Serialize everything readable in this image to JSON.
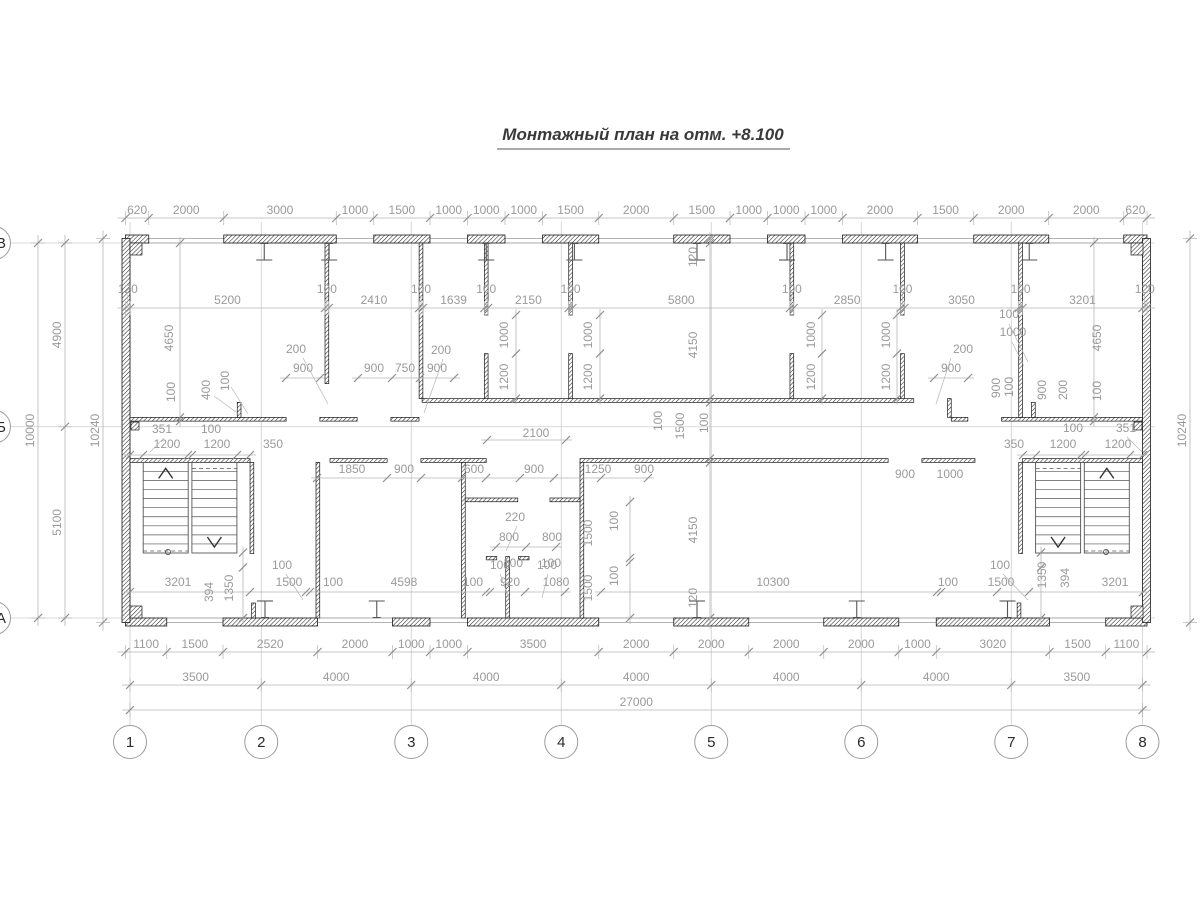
{
  "title": {
    "text": "Монтажный план на отм. +8.100"
  },
  "colors": {
    "dim_line": "#b5b5b5",
    "tick": "#8f8f8f",
    "dim_text": "#9a9a9a",
    "grid": "#cdcdcd",
    "wall_stroke": "#1a1a1a",
    "stair": "#555555",
    "face_line": "#9a9a9a",
    "bubble": "#9c9c9c",
    "title_underline": "#555555"
  },
  "scale": {
    "s": 0.0375,
    "ox": 125.5,
    "oy": 238.5
  },
  "grid": {
    "cols": [
      {
        "label": "1",
        "mm": 120
      },
      {
        "label": "2",
        "mm": 3620
      },
      {
        "label": "3",
        "mm": 7620
      },
      {
        "label": "4",
        "mm": 11620
      },
      {
        "label": "5",
        "mm": 15620
      },
      {
        "label": "6",
        "mm": 19620
      },
      {
        "label": "7",
        "mm": 23620
      },
      {
        "label": "8",
        "mm": 27120
      }
    ],
    "rows": [
      {
        "label": "В",
        "mm": 120
      },
      {
        "label": "Б",
        "mm": 5020
      },
      {
        "label": "А",
        "mm": 10120
      }
    ],
    "bubble_y": 742,
    "bubble_x": -6,
    "r": 16.5
  },
  "building": {
    "w_mm": 27240,
    "h_mm": 10240
  },
  "walls_ext": [
    {
      "ex": "t",
      "segs": [
        [
          0,
          0,
          620,
          120
        ],
        [
          2620,
          0,
          3000,
          120
        ],
        [
          6620,
          0,
          1500,
          120
        ],
        [
          9120,
          0,
          1000,
          120
        ],
        [
          11120,
          0,
          1500,
          120
        ],
        [
          14620,
          0,
          1500,
          120
        ],
        [
          17120,
          0,
          1000,
          120
        ],
        [
          19120,
          0,
          2000,
          120
        ],
        [
          22620,
          0,
          2000,
          120
        ],
        [
          26620,
          0,
          620,
          120
        ]
      ]
    },
    {
      "ex": "b",
      "segs": [
        [
          0,
          10120,
          1100,
          120
        ],
        [
          2600,
          10120,
          2520,
          120
        ],
        [
          7120,
          10120,
          1000,
          120
        ],
        [
          9120,
          10120,
          3500,
          120
        ],
        [
          14620,
          10120,
          2000,
          120
        ],
        [
          18620,
          10120,
          2000,
          120
        ],
        [
          21620,
          10120,
          3020,
          120
        ],
        [
          26140,
          10120,
          1100,
          120
        ]
      ]
    },
    {
      "ex": "l",
      "segs": [
        [
          0,
          0,
          120,
          10240
        ]
      ]
    },
    {
      "ex": "r",
      "segs": [
        [
          27120,
          0,
          120,
          10240
        ]
      ]
    }
  ],
  "walls_int": [
    [
      120,
      4770,
      4163,
      100
    ],
    [
      5183,
      4770,
      994,
      100
    ],
    [
      7077,
      4770,
      750,
      100
    ],
    [
      2980,
      4370,
      100,
      400
    ],
    [
      7910,
      4270,
      13110,
      100
    ],
    [
      21920,
      4270,
      100,
      500
    ],
    [
      22020,
      4770,
      443,
      100
    ],
    [
      23363,
      4770,
      3757,
      100
    ],
    [
      24160,
      4370,
      100,
      400
    ],
    [
      5320,
      120,
      100,
      3750
    ],
    [
      7830,
      120,
      100,
      4150
    ],
    [
      9569,
      120,
      100,
      1920
    ],
    [
      9569,
      3070,
      100,
      1200
    ],
    [
      11819,
      120,
      100,
      1920
    ],
    [
      11819,
      3070,
      100,
      1200
    ],
    [
      17719,
      120,
      100,
      1920
    ],
    [
      17719,
      3070,
      100,
      1200
    ],
    [
      20669,
      120,
      100,
      1920
    ],
    [
      20669,
      3070,
      100,
      1200
    ],
    [
      23819,
      120,
      100,
      4650
    ],
    [
      120,
      5870,
      3201,
      100
    ],
    [
      5453,
      5870,
      1524,
      100
    ],
    [
      7877,
      5870,
      1743,
      100
    ],
    [
      12120,
      5870,
      8217,
      100
    ],
    [
      21237,
      5870,
      1416,
      100
    ],
    [
      23919,
      5870,
      3201,
      100
    ],
    [
      5080,
      5970,
      100,
      4150
    ],
    [
      8960,
      5970,
      100,
      4150
    ],
    [
      12120,
      5970,
      100,
      4150
    ],
    [
      9060,
      6920,
      1400,
      100
    ],
    [
      11320,
      6920,
      800,
      100
    ],
    [
      9620,
      8480,
      280,
      90
    ],
    [
      10480,
      8480,
      280,
      90
    ],
    [
      10140,
      8480,
      100,
      1640
    ],
    [
      3321,
      5970,
      100,
      2430
    ],
    [
      23819,
      5970,
      100,
      2430
    ],
    [
      3363,
      9720,
      100,
      400
    ],
    [
      23777,
      9720,
      100,
      400
    ]
  ],
  "corner_pads": [
    [
      130,
      243,
      12,
      12
    ],
    [
      130,
      606,
      12,
      12
    ],
    [
      1131,
      243,
      12,
      12
    ],
    [
      1131,
      606,
      12,
      12
    ],
    [
      131,
      422,
      8,
      8
    ],
    [
      1134,
      422,
      8,
      8
    ]
  ],
  "beams": {
    "top_mm": [
      3700,
      5430,
      9620,
      11970,
      15240,
      17640,
      20270,
      24100
    ],
    "bottom_mm": [
      3720,
      6700,
      15240,
      19500,
      23520
    ]
  },
  "stairs": [
    {
      "f1": [
        143.2,
        188.2
      ],
      "f2": [
        191.9,
        236.9
      ],
      "yt": 462.4,
      "yb": 553,
      "up": "f1",
      "circle_x": 168
    },
    {
      "f1": [
        1035.6,
        1080.6
      ],
      "f2": [
        1084.3,
        1129.3
      ],
      "yt": 462.4,
      "yb": 553,
      "up": "f2",
      "circle_x": 1106
    }
  ],
  "chains_h": [
    {
      "y": 218,
      "ticks": [
        0,
        620,
        2620,
        5620,
        6620,
        8120,
        9120,
        10120,
        11120,
        12620,
        14620,
        16120,
        17120,
        18120,
        19120,
        21120,
        22620,
        24620,
        26620,
        27240
      ],
      "labels": [
        "620",
        "2000",
        "3000",
        "1000",
        "1500",
        "1000",
        "1000",
        "1000",
        "1500",
        "2000",
        "1500",
        "1000",
        "1000",
        "1000",
        "2000",
        "1500",
        "2000",
        "2000",
        "620"
      ]
    },
    {
      "y": 308,
      "ticks": [
        0,
        120,
        5320,
        5420,
        7830,
        7930,
        9569,
        9669,
        11819,
        11919,
        17719,
        17819,
        20669,
        20769,
        23819,
        23919,
        27120,
        27240
      ],
      "labels": [
        "120",
        "5200",
        "100",
        "2410",
        "100",
        "1639",
        "100",
        "2150",
        "100",
        "5800",
        "100",
        "2850",
        "100",
        "3050",
        "100",
        "3201",
        "120"
      ]
    },
    {
      "y": 652,
      "ticks": [
        0,
        1100,
        2600,
        5120,
        7120,
        8120,
        9120,
        12620,
        14620,
        16620,
        18620,
        20620,
        21620,
        24640,
        26140,
        27240
      ],
      "labels": [
        "1100",
        "1500",
        "2520",
        "2000",
        "1000",
        "1000",
        "3500",
        "2000",
        "2000",
        "2000",
        "2000",
        "1000",
        "3020",
        "1500",
        "1100"
      ]
    },
    {
      "y": 685,
      "ticks": [
        120,
        3620,
        7620,
        11620,
        15620,
        19620,
        23620,
        27120
      ],
      "labels": [
        "3500",
        "4000",
        "4000",
        "4000",
        "4000",
        "4000",
        "3500"
      ]
    },
    {
      "y": 710,
      "ticks": [
        120,
        27120
      ],
      "labels": [
        "27000"
      ]
    }
  ],
  "chains_v": [
    {
      "x": 38,
      "ticks_mm": [
        120,
        10120
      ],
      "labels": [
        "10000"
      ]
    },
    {
      "x": 65,
      "ticks_mm": [
        120,
        5020,
        10120
      ],
      "labels": [
        "4900",
        "5100"
      ]
    },
    {
      "x": 103,
      "ticks_mm": [
        0,
        10240
      ],
      "labels": [
        "10240"
      ]
    },
    {
      "x": 1190,
      "ticks_mm": [
        0,
        10240
      ],
      "labels": [
        "10240"
      ]
    }
  ],
  "extra_h": [
    {
      "y": 378,
      "ticks": [
        286,
        320
      ]
    },
    {
      "y": 378,
      "ticks": [
        358,
        392,
        420,
        454
      ]
    },
    {
      "y": 378,
      "ticks": [
        934,
        968
      ]
    },
    {
      "y": 455,
      "ticks": [
        130,
        143,
        188,
        192,
        237,
        250
      ]
    },
    {
      "y": 455,
      "ticks": [
        1023,
        1036,
        1081,
        1085,
        1130,
        1143
      ]
    },
    {
      "y": 478,
      "ticks": [
        317,
        387,
        421,
        462,
        486,
        520,
        554,
        601,
        648
      ]
    },
    {
      "y": 440,
      "ticks": [
        487,
        566
      ]
    },
    {
      "y": 547,
      "ticks": [
        496,
        526,
        556
      ]
    },
    {
      "y": 592,
      "ticks": [
        130,
        250,
        306,
        310,
        486,
        490,
        525,
        565
      ]
    },
    {
      "y": 592,
      "ticks": [
        601,
        937,
        941,
        997,
        1029,
        1143
      ]
    }
  ],
  "extra_v": [
    {
      "x": 243,
      "ticks": [
        552.6,
        567.4,
        618.1
      ]
    },
    {
      "x": 1041,
      "ticks": [
        552.6,
        567.4,
        618.1
      ]
    },
    {
      "x": 630,
      "ticks": [
        502,
        558,
        562,
        618
      ]
    },
    {
      "x": 710,
      "ticks": [
        238.5,
        243,
        398.6,
        402.4,
        458.6,
        462.4,
        618.1,
        622.6
      ]
    },
    {
      "x": 180,
      "ticks": [
        243,
        417.4,
        421.1
      ]
    },
    {
      "x": 1094,
      "ticks": [
        243,
        417.4,
        421.1
      ]
    },
    {
      "x": 516,
      "ticks": [
        315,
        353.6,
        398.6
      ]
    },
    {
      "x": 600,
      "ticks": [
        315,
        353.6,
        398.6
      ]
    },
    {
      "x": 822,
      "ticks": [
        315,
        353.6,
        398.6
      ]
    },
    {
      "x": 897,
      "ticks": [
        315,
        353.6,
        398.6
      ]
    }
  ],
  "labels": [
    [
      173,
      338,
      90,
      "4650"
    ],
    [
      175,
      392,
      90,
      "100"
    ],
    [
      210,
      390,
      90,
      "400"
    ],
    [
      229,
      381,
      90,
      "100"
    ],
    [
      296,
      353,
      0,
      "200"
    ],
    [
      303,
      372,
      0,
      "900"
    ],
    [
      441,
      354,
      0,
      "200"
    ],
    [
      374,
      372,
      0,
      "900"
    ],
    [
      405,
      372,
      0,
      "750"
    ],
    [
      437,
      372,
      0,
      "900"
    ],
    [
      508,
      335,
      90,
      "1000"
    ],
    [
      508,
      377,
      90,
      "1200"
    ],
    [
      592,
      335,
      90,
      "1000"
    ],
    [
      592,
      377,
      90,
      "1200"
    ],
    [
      815,
      335,
      90,
      "1000"
    ],
    [
      815,
      377,
      90,
      "1200"
    ],
    [
      890,
      335,
      90,
      "1000"
    ],
    [
      890,
      377,
      90,
      "1200"
    ],
    [
      697,
      257,
      90,
      "120"
    ],
    [
      697,
      345,
      90,
      "4150"
    ],
    [
      662,
      421,
      90,
      "100"
    ],
    [
      684,
      426,
      90,
      "1500"
    ],
    [
      708,
      423,
      90,
      "100"
    ],
    [
      697,
      530,
      90,
      "4150"
    ],
    [
      697,
      598,
      90,
      "120"
    ],
    [
      1009,
      318,
      0,
      "100"
    ],
    [
      1013,
      336,
      0,
      "1000"
    ],
    [
      963,
      353,
      0,
      "200"
    ],
    [
      951,
      372,
      0,
      "900"
    ],
    [
      1000,
      388,
      90,
      "900"
    ],
    [
      1013,
      387,
      90,
      "100"
    ],
    [
      1046,
      390,
      90,
      "900"
    ],
    [
      1067,
      390,
      90,
      "200"
    ],
    [
      1101,
      338,
      90,
      "4650"
    ],
    [
      1101,
      391,
      90,
      "100"
    ],
    [
      162,
      433,
      0,
      "351"
    ],
    [
      211,
      433,
      0,
      "100"
    ],
    [
      167,
      448,
      0,
      "1200"
    ],
    [
      217,
      448,
      0,
      "1200"
    ],
    [
      273,
      448,
      0,
      "350"
    ],
    [
      1014,
      448,
      0,
      "350"
    ],
    [
      1063,
      448,
      0,
      "1200"
    ],
    [
      1118,
      448,
      0,
      "1200"
    ],
    [
      1073,
      432,
      0,
      "100"
    ],
    [
      1126,
      432,
      0,
      "351"
    ],
    [
      352,
      473,
      0,
      "1850"
    ],
    [
      404,
      473,
      0,
      "900"
    ],
    [
      474,
      473,
      0,
      "600"
    ],
    [
      534,
      473,
      0,
      "900"
    ],
    [
      598,
      473,
      0,
      "1250"
    ],
    [
      644,
      473,
      0,
      "900"
    ],
    [
      536,
      437,
      0,
      "2100"
    ],
    [
      905,
      478,
      0,
      "900"
    ],
    [
      950,
      478,
      0,
      "1000"
    ],
    [
      515,
      521,
      0,
      "220"
    ],
    [
      509,
      541,
      0,
      "800"
    ],
    [
      552,
      541,
      0,
      "800"
    ],
    [
      513,
      567,
      0,
      "100"
    ],
    [
      551,
      567,
      0,
      "100"
    ],
    [
      592,
      533,
      90,
      "1500"
    ],
    [
      618,
      521,
      90,
      "100"
    ],
    [
      592,
      588,
      90,
      "1500"
    ],
    [
      618,
      576,
      90,
      "100"
    ],
    [
      178,
      586,
      0,
      "3201"
    ],
    [
      282,
      569,
      0,
      "100"
    ],
    [
      289,
      586,
      0,
      "1500"
    ],
    [
      333,
      586,
      0,
      "100"
    ],
    [
      404,
      586,
      0,
      "4598"
    ],
    [
      473,
      586,
      0,
      "100"
    ],
    [
      510,
      586,
      0,
      "920"
    ],
    [
      556,
      586,
      0,
      "1080"
    ],
    [
      500,
      569,
      0,
      "100"
    ],
    [
      547,
      569,
      0,
      "100"
    ],
    [
      773,
      586,
      0,
      "10300"
    ],
    [
      948,
      586,
      0,
      "100"
    ],
    [
      1001,
      586,
      0,
      "1500"
    ],
    [
      1000,
      569,
      0,
      "100"
    ],
    [
      1115,
      586,
      0,
      "3201"
    ],
    [
      213,
      592,
      90,
      "394"
    ],
    [
      233,
      588,
      90,
      "1350"
    ],
    [
      1046,
      575,
      90,
      "1350"
    ],
    [
      1069,
      578,
      90,
      "394"
    ]
  ],
  "leaders": [
    [
      303,
      358,
      328,
      404
    ],
    [
      443,
      359,
      424,
      413
    ],
    [
      951,
      358,
      936,
      404
    ],
    [
      1012,
      342,
      1024,
      366
    ],
    [
      1009,
      324,
      1028,
      362
    ],
    [
      214,
      396,
      240,
      415
    ],
    [
      231,
      387,
      248,
      414
    ],
    [
      517,
      526,
      506,
      551
    ],
    [
      286,
      574,
      303,
      600
    ],
    [
      1003,
      574,
      1028,
      600
    ],
    [
      164,
      438,
      150,
      452
    ],
    [
      1127,
      437,
      1142,
      452
    ],
    [
      500,
      574,
      509,
      598
    ],
    [
      548,
      574,
      542,
      598
    ]
  ]
}
